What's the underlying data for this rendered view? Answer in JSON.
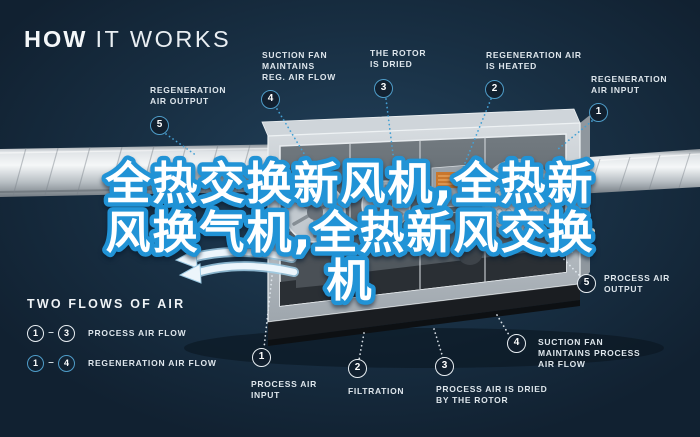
{
  "colors": {
    "background": "#15283A",
    "accent_blue": "#3E96CC",
    "headline_stroke": "#2193D6",
    "label_text": "#DEE6EC"
  },
  "title": {
    "bold": "HOW",
    "light": "IT WORKS"
  },
  "headline": {
    "lines": [
      "全热交换新风机,全热新",
      "风换气机,全热新风交换",
      "机"
    ]
  },
  "legend": {
    "title": "TWO FLOWS OF AIR",
    "rows": [
      {
        "from": "1",
        "to": "3",
        "dash": "–",
        "label": "PROCESS AIR FLOW"
      },
      {
        "from": "1",
        "to": "4",
        "dash": "–",
        "label": "REGENERATION AIR FLOW"
      }
    ]
  },
  "callouts": {
    "top": [
      {
        "num": "5",
        "lines": [
          "REGENERATION",
          "AIR OUTPUT"
        ]
      },
      {
        "num": "4",
        "lines": [
          "SUCTION FAN",
          "MAINTAINS",
          "REG. AIR FLOW"
        ]
      },
      {
        "num": "3",
        "lines": [
          "THE ROTOR",
          "IS DRIED"
        ]
      },
      {
        "num": "2",
        "lines": [
          "REGENERATION AIR",
          "IS HEATED"
        ]
      },
      {
        "num": "1",
        "lines": [
          "REGENERATION",
          "AIR INPUT"
        ]
      }
    ],
    "bottom": [
      {
        "num": "1",
        "lines": [
          "PROCESS AIR",
          "INPUT"
        ]
      },
      {
        "num": "2",
        "lines": [
          "FILTRATION"
        ]
      },
      {
        "num": "3",
        "lines": [
          "PROCESS AIR IS DRIED",
          "BY THE ROTOR"
        ]
      },
      {
        "num": "4",
        "lines": [
          "SUCTION FAN",
          "MAINTAINS PROCESS",
          "AIR FLOW"
        ]
      },
      {
        "num": "5",
        "lines": [
          "PROCESS AIR",
          "OUTPUT"
        ]
      }
    ]
  }
}
